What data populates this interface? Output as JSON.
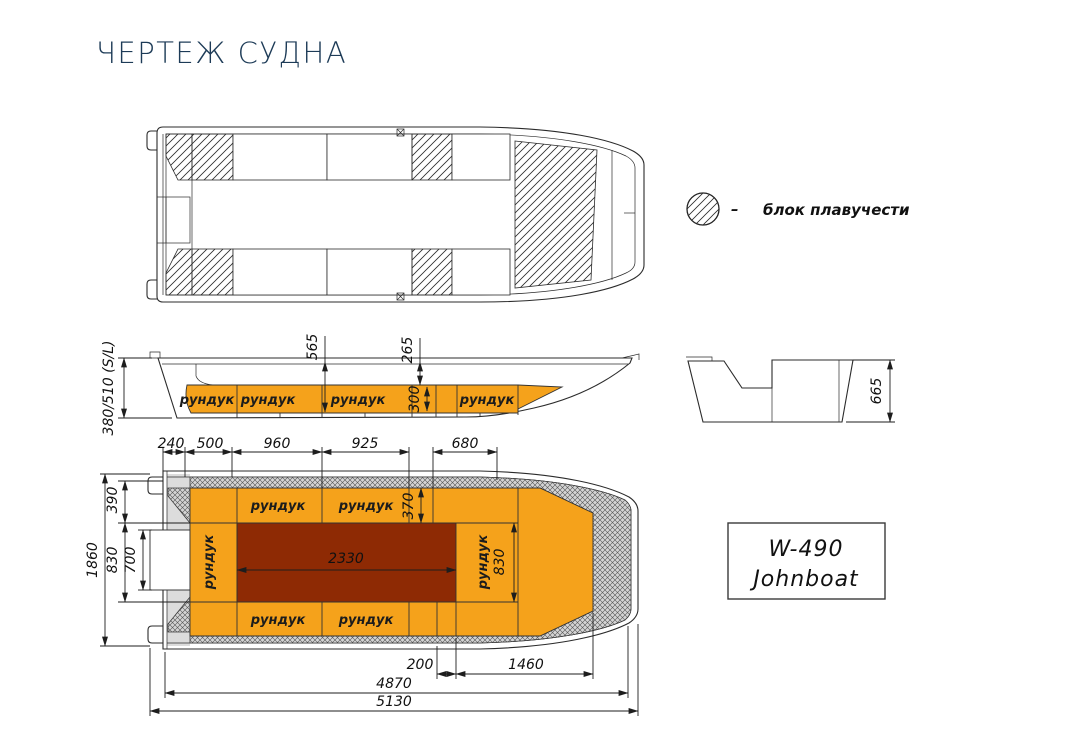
{
  "title": "ЧЕРТЕЖ СУДНА",
  "legend": {
    "dash": "–",
    "label": "блок плавучести"
  },
  "model": {
    "line1": "W-490",
    "line2": "Johnboat"
  },
  "colors": {
    "orange": "#F5A21B",
    "dark_red": "#8E2A04",
    "hull_gray": "#DCDCDC",
    "title": "#1D3B57"
  },
  "side_view": {
    "lockers": [
      "рундук",
      "рундук",
      "рундук",
      "рундук"
    ],
    "dim_depth": "380/510 (S/L)",
    "dim_565": "565",
    "dim_265": "265",
    "dim_300": "300"
  },
  "transom_view": {
    "dim_665": "665"
  },
  "bottom_view": {
    "top_dims": [
      "240",
      "500",
      "960",
      "925",
      "680"
    ],
    "left_dims": {
      "d390": "390",
      "d1860": "1860",
      "d830": "830",
      "d700": "700"
    },
    "lockers_top": [
      "рундук",
      "рундук"
    ],
    "lockers_bottom": [
      "рундук",
      "рундук"
    ],
    "locker_left": "рундук",
    "locker_right": "рундук",
    "dim_370": "370",
    "dim_2330": "2330",
    "dim_830_right": "830",
    "bottom_dims": {
      "d200": "200",
      "d1460": "1460",
      "d4870": "4870",
      "d5130": "5130"
    }
  }
}
